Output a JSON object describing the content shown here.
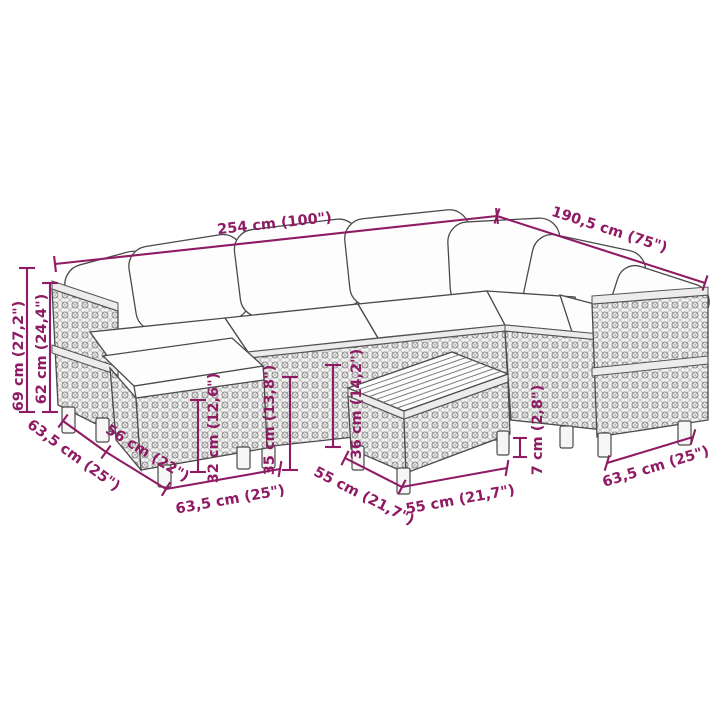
{
  "diagram": {
    "accent_color": "#8e1b63",
    "line_art_color": "#4a4a4a",
    "labels": {
      "overall_width": "254 cm (100\")",
      "overall_depth": "190,5 cm (75\")",
      "back_height": "69 cm (27,2\")",
      "armrest_height": "62 cm (24,4\")",
      "left_module_depth": "63,5 cm (25\")",
      "footstool_depth": "56 cm (22\")",
      "footstool_height": "32 cm (12,6\")",
      "seat_height": "35 cm (13,8\")",
      "table_height": "36 cm (14,2\")",
      "left_module_width": "63,5 cm (25\")",
      "table_depth": "55 cm (21,7\")",
      "table_width": "55 cm (21,7\")",
      "leg_height": "7 cm (2,8\")",
      "right_module_depth": "63,5 cm (25\")"
    }
  }
}
